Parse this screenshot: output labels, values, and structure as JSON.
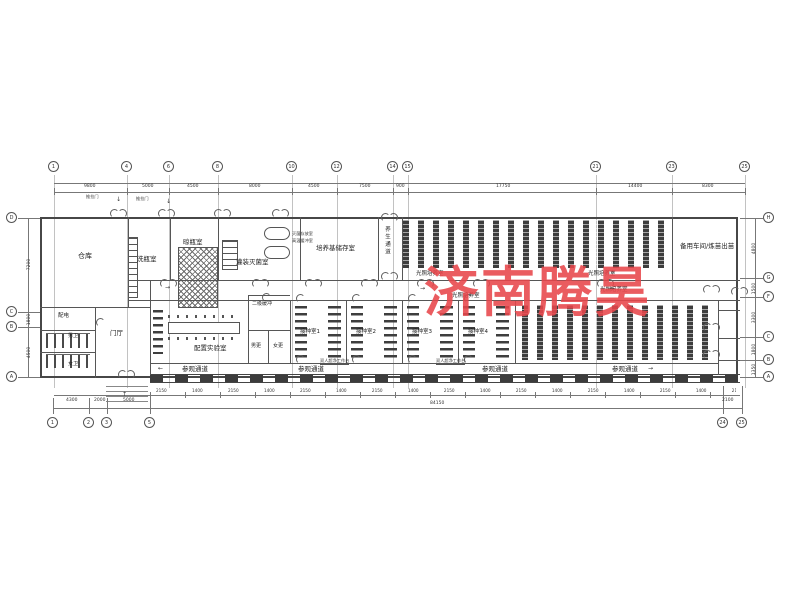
{
  "watermark": {
    "text": "济南腾昊",
    "color": "#e8464b"
  },
  "labels": {
    "warehouse": "仓库",
    "wash": "洗瓶室",
    "dry": "晾瓶室",
    "fill": "灌装灭菌室",
    "callout_line1": "灭菌存放室",
    "callout_line2": "高温缓冲室",
    "medium": "培养基储存室",
    "cure_corridor": "养生通道",
    "light_room": "光照培养室",
    "spare": "备用车间/炼苗出苗",
    "power": "配电",
    "wc_m": "男卫",
    "wc_f": "女卫",
    "lobby": "门厅",
    "prep_lab": "配置实验室",
    "buffer2": "二级缓冲",
    "chg_m": "男更",
    "chg_f": "女更",
    "inoc": [
      "接种室1",
      "接种室2",
      "接种室3",
      "接种室4"
    ],
    "visit": "参观通道",
    "door_callout": "推拉门",
    "bench_callout": "双人超净工作台"
  },
  "grid": {
    "top": [
      "1",
      "4",
      "6",
      "8",
      "10",
      "12",
      "14",
      "15",
      "21",
      "23",
      "25"
    ],
    "bottom_left": [
      "1",
      "2",
      "3",
      "5"
    ],
    "bottom_right": [
      "24",
      "25"
    ],
    "left": [
      "D",
      "C",
      "B",
      "A"
    ],
    "right": [
      "H",
      "G",
      "F",
      "C",
      "B",
      "A"
    ]
  },
  "dims": {
    "top": [
      "9800",
      "5000",
      "4500",
      "8000",
      "4500",
      "7500",
      "900",
      "17750",
      "14400",
      "8300"
    ],
    "left": [
      "7200",
      "1800",
      "4500"
    ],
    "right": [
      "4800",
      "1500",
      "3300",
      "1800",
      "1350"
    ],
    "bottom_left": [
      "4300",
      "2000",
      "5000"
    ],
    "bottom_run": "2150 1400 2150 1400 2150 1400 2150 1400 2150 1400 2150 1400 2150 1400 2150 1400 2150",
    "bottom_total": "84150",
    "bottom_right": "2100"
  },
  "symbols": {
    "arrow_right": "→",
    "arrow_left": "←",
    "arrow_down": "↓",
    "arrow_up": "↑"
  }
}
